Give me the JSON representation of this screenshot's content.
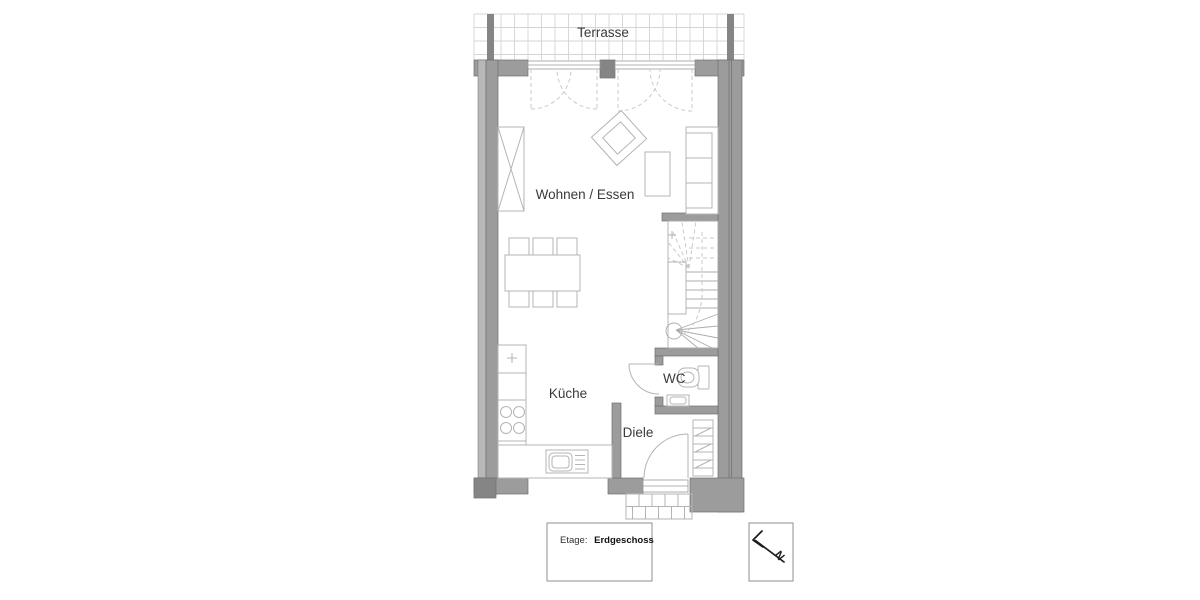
{
  "plan": {
    "terrace_label": "Terrasse",
    "living_label": "Wohnen / Essen",
    "kitchen_label": "Küche",
    "wc_label": "WC",
    "hall_label": "Diele"
  },
  "legend": {
    "floor_prefix": "Etage:",
    "floor_name": "Erdgeschoss"
  },
  "compass": {
    "north": "N"
  },
  "colors": {
    "wall": "#9c9c9c",
    "wall-dark": "#858585",
    "wall-edge": "#6f6f6f",
    "wall-light": "#b8b8b8",
    "furniture": "#b4b4b4",
    "stair": "#adadad",
    "dash": "#c9c9c9",
    "grid": "#d4d4d4",
    "label": "#3a3a3a",
    "ink": "#1c1c1c",
    "box-border": "#8f8f8f"
  }
}
